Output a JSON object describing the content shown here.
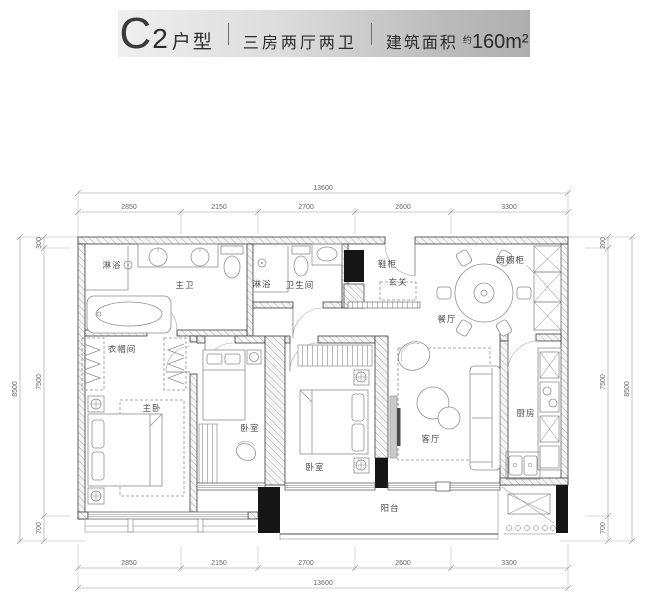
{
  "header": {
    "unit_letter": "C",
    "unit_number": "2",
    "unit_suffix": "户型",
    "separator": "|",
    "rooms_summary": "三房两厅两卫",
    "area_label": "建筑面积",
    "area_approx": "约",
    "area_value": "160m²"
  },
  "plan": {
    "rooms": {
      "master_bath": "主卫",
      "shower_a": "淋浴",
      "shower_b": "淋浴",
      "bathroom": "卫生间",
      "shoe_cabinet": "鞋柜",
      "foyer": "玄关",
      "west_cabinet": "西橱柜",
      "dining": "餐厅",
      "cloakroom": "衣帽间",
      "master_bedroom": "主卧",
      "bedroom_a": "卧室",
      "bedroom_b": "卧室",
      "living_room": "客厅",
      "kitchen": "厨房",
      "balcony": "阳台"
    },
    "dimensions": {
      "top_total": "13600",
      "top_segments": [
        "2850",
        "2150",
        "2700",
        "2600",
        "3300"
      ],
      "bottom_total": "13600",
      "bottom_segments": [
        "2850",
        "2150",
        "2700",
        "2600",
        "3300"
      ],
      "left_total": "8500",
      "left_segments": [
        "300",
        "7500",
        "700"
      ],
      "right_total": "8500",
      "right_segments": [
        "200",
        "7500",
        "700"
      ]
    }
  }
}
